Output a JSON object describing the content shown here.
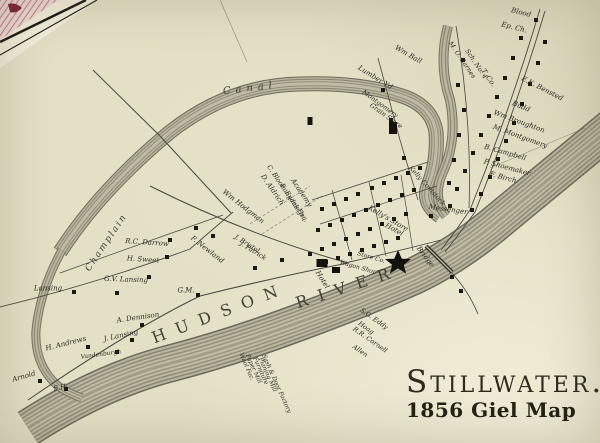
{
  "title": {
    "main": "Stillwater.",
    "caption": "1856 Giel Map"
  },
  "colors": {
    "paper": "#e4e0c6",
    "ink": "#2c2920",
    "water_dark": "#6d695a",
    "water_light": "#bcb7a0",
    "adjacent_sheet_pink": "#bf6277",
    "adjacent_sheet_red": "#7c2437",
    "house_marker": "#1b1914"
  },
  "map": {
    "water_features": [
      "Champlain Canal",
      "Hudson River"
    ],
    "landmark": "star-marker",
    "labels": [
      {
        "t": "Blood",
        "x": 521,
        "y": 13,
        "r": 14
      },
      {
        "t": "Ep. Ch.",
        "x": 514,
        "y": 28,
        "r": 14
      },
      {
        "t": "Wm Ball",
        "x": 408,
        "y": 55,
        "r": 30
      },
      {
        "t": "Lumber Yd",
        "x": 375,
        "y": 78,
        "r": 32
      },
      {
        "t": "Montgomery",
        "x": 380,
        "y": 104,
        "r": 36,
        "fs": 6.5
      },
      {
        "t": "Grain Store",
        "x": 386,
        "y": 116,
        "r": 36,
        "fs": 6.5
      },
      {
        "t": "M. O. Barnes",
        "x": 462,
        "y": 60,
        "r": 56,
        "fs": 6.5
      },
      {
        "t": "Sch. No. 4",
        "x": 476,
        "y": 64,
        "r": 56,
        "fs": 6.5
      },
      {
        "t": "T. Co.",
        "x": 488,
        "y": 78,
        "r": 56
      },
      {
        "t": "E.K. Bensted",
        "x": 542,
        "y": 89,
        "r": 27
      },
      {
        "t": "Budd",
        "x": 521,
        "y": 107,
        "r": 22
      },
      {
        "t": "Wm Broughton",
        "x": 519,
        "y": 122,
        "r": 20
      },
      {
        "t": "M. Montgomery",
        "x": 520,
        "y": 137,
        "r": 20
      },
      {
        "t": "B. Campbell",
        "x": 505,
        "y": 153,
        "r": 16
      },
      {
        "t": "P. Shoemaker",
        "x": 507,
        "y": 168,
        "r": 15
      },
      {
        "t": "F. Birch",
        "x": 503,
        "y": 178,
        "r": 15
      },
      {
        "t": "Kelly Comstock",
        "x": 427,
        "y": 186,
        "r": 48,
        "fs": 6.5
      },
      {
        "t": "Messenger",
        "x": 448,
        "y": 210,
        "r": 8
      },
      {
        "t": "Kelly's Store",
        "x": 388,
        "y": 219,
        "r": 30
      },
      {
        "t": "Hotel",
        "x": 394,
        "y": 230,
        "r": 28
      },
      {
        "t": "Bridge",
        "x": 425,
        "y": 257,
        "r": 52
      },
      {
        "t": "Academy",
        "x": 301,
        "y": 193,
        "r": 56
      },
      {
        "t": "C. Bloomingdale Jr.",
        "x": 286,
        "y": 192,
        "r": 56,
        "fs": 6.5
      },
      {
        "t": "E. Evans Esq.",
        "x": 294,
        "y": 203,
        "r": 56,
        "fs": 6.5
      },
      {
        "t": "D. Aldrich",
        "x": 272,
        "y": 190,
        "r": 56
      },
      {
        "t": "Wm Hodgman",
        "x": 243,
        "y": 207,
        "r": 38
      },
      {
        "t": "F. Newland",
        "x": 207,
        "y": 250,
        "r": 38
      },
      {
        "t": "J. Bristol",
        "x": 247,
        "y": 244,
        "r": 32,
        "fs": 6.5
      },
      {
        "t": "J. Patrick",
        "x": 253,
        "y": 251,
        "r": 32,
        "fs": 6.5
      },
      {
        "t": "R.C. Darrow",
        "x": 147,
        "y": 243,
        "r": 4
      },
      {
        "t": "H. Sweet",
        "x": 143,
        "y": 260,
        "r": 4
      },
      {
        "t": "G.V. Lansing",
        "x": 126,
        "y": 280,
        "r": 2
      },
      {
        "t": "Lansing",
        "x": 48,
        "y": 289,
        "r": 0
      },
      {
        "t": "G.M.",
        "x": 186,
        "y": 291,
        "r": 0
      },
      {
        "t": "A. Dennison",
        "x": 138,
        "y": 318,
        "r": -8
      },
      {
        "t": "J. Lansing",
        "x": 121,
        "y": 336,
        "r": -12
      },
      {
        "t": "H. Andrews",
        "x": 66,
        "y": 344,
        "r": -14
      },
      {
        "t": "Vandenburgh",
        "x": 101,
        "y": 355,
        "r": -8,
        "fs": 6
      },
      {
        "t": "Arnold",
        "x": 24,
        "y": 377,
        "r": -16
      },
      {
        "t": "S.H.",
        "x": 61,
        "y": 388,
        "r": -10
      },
      {
        "t": "S.G. Eddy",
        "x": 374,
        "y": 319,
        "r": 35,
        "fs": 6.5
      },
      {
        "t": "Hoag",
        "x": 366,
        "y": 328,
        "r": 35,
        "fs": 6.5
      },
      {
        "t": "R.R. Cornell",
        "x": 370,
        "y": 340,
        "r": 35,
        "fs": 6.5
      },
      {
        "t": "Allen",
        "x": 360,
        "y": 351,
        "r": 35,
        "fs": 6.5
      },
      {
        "t": "Sash & Door Factory",
        "x": 276,
        "y": 384,
        "r": 66,
        "fs": 6
      },
      {
        "t": "Planing Mill",
        "x": 267,
        "y": 375,
        "r": 66,
        "fs": 6
      },
      {
        "t": "Furniture",
        "x": 260,
        "y": 371,
        "r": 66,
        "fs": 6
      },
      {
        "t": "Paper Mill",
        "x": 253,
        "y": 369,
        "r": 66,
        "fs": 6
      },
      {
        "t": "Wool Fac.",
        "x": 246,
        "y": 367,
        "r": 66,
        "fs": 6
      },
      {
        "t": "Hotel",
        "x": 322,
        "y": 280,
        "r": 58
      },
      {
        "t": "Wagon Shop",
        "x": 358,
        "y": 268,
        "r": 16,
        "fs": 6
      },
      {
        "t": "Store Co.",
        "x": 371,
        "y": 258,
        "r": 16,
        "fs": 6
      },
      {
        "t": "Canal",
        "x": 250,
        "y": 89,
        "r": -7,
        "cls": "canal",
        "ls": 5
      },
      {
        "t": "Champlain",
        "x": 107,
        "y": 243,
        "r": -56,
        "cls": "champlain",
        "ls": 2
      },
      {
        "t": "HUDSON",
        "x": 220,
        "y": 313,
        "r": -21,
        "cls": "water",
        "ls": 11,
        "fs": 16
      },
      {
        "t": "RIVER",
        "x": 348,
        "y": 287,
        "r": -18,
        "cls": "water",
        "ls": 11,
        "fs": 16
      }
    ],
    "houses": [
      [
        536,
        20
      ],
      [
        545,
        42
      ],
      [
        538,
        63
      ],
      [
        530,
        84
      ],
      [
        522,
        104
      ],
      [
        514,
        123
      ],
      [
        506,
        141
      ],
      [
        498,
        159
      ],
      [
        490,
        177
      ],
      [
        481,
        194
      ],
      [
        472,
        210
      ],
      [
        521,
        38
      ],
      [
        513,
        58
      ],
      [
        505,
        78
      ],
      [
        497,
        97
      ],
      [
        489,
        116
      ],
      [
        481,
        135
      ],
      [
        473,
        153
      ],
      [
        465,
        171
      ],
      [
        457,
        189
      ],
      [
        450,
        206
      ],
      [
        463,
        60
      ],
      [
        458,
        85
      ],
      [
        464,
        110
      ],
      [
        459,
        135
      ],
      [
        454,
        160
      ],
      [
        449,
        183
      ],
      [
        420,
        168
      ],
      [
        408,
        173
      ],
      [
        396,
        178
      ],
      [
        384,
        183
      ],
      [
        372,
        188
      ],
      [
        358,
        194
      ],
      [
        346,
        199
      ],
      [
        334,
        204
      ],
      [
        322,
        209
      ],
      [
        414,
        190
      ],
      [
        402,
        195
      ],
      [
        390,
        200
      ],
      [
        378,
        205
      ],
      [
        366,
        210
      ],
      [
        354,
        215
      ],
      [
        342,
        220
      ],
      [
        330,
        225
      ],
      [
        318,
        230
      ],
      [
        406,
        214
      ],
      [
        394,
        219
      ],
      [
        382,
        224
      ],
      [
        370,
        229
      ],
      [
        358,
        234
      ],
      [
        346,
        239
      ],
      [
        334,
        244
      ],
      [
        322,
        249
      ],
      [
        310,
        254
      ],
      [
        398,
        238
      ],
      [
        386,
        242
      ],
      [
        374,
        246
      ],
      [
        362,
        250
      ],
      [
        350,
        254
      ],
      [
        338,
        258
      ],
      [
        326,
        262
      ],
      [
        391,
        120
      ],
      [
        404,
        158
      ],
      [
        383,
        90
      ],
      [
        196,
        228
      ],
      [
        213,
        236
      ],
      [
        170,
        240
      ],
      [
        167,
        257
      ],
      [
        149,
        277
      ],
      [
        117,
        293
      ],
      [
        74,
        292
      ],
      [
        142,
        325
      ],
      [
        132,
        340
      ],
      [
        117,
        352
      ],
      [
        88,
        347
      ],
      [
        40,
        381
      ],
      [
        66,
        389
      ],
      [
        198,
        295
      ],
      [
        255,
        268
      ],
      [
        282,
        260
      ],
      [
        452,
        277
      ],
      [
        461,
        291
      ],
      [
        431,
        216
      ]
    ],
    "buildings": [
      [
        393,
        128,
        8,
        12
      ],
      [
        322,
        263,
        11,
        8
      ],
      [
        336,
        270,
        8,
        6
      ],
      [
        310,
        121,
        5,
        8
      ]
    ]
  }
}
